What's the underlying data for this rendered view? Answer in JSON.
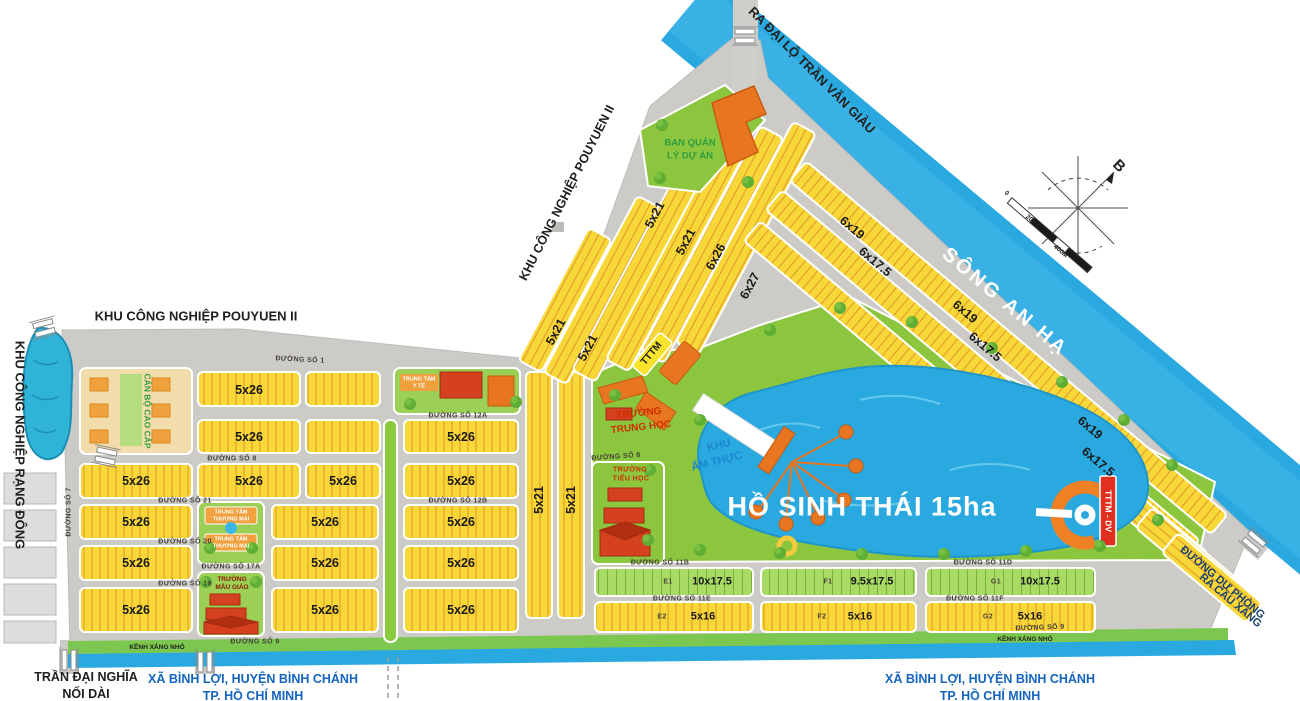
{
  "region_labels": {
    "river": "SÔNG AN HẠ",
    "lake": "HỒ SINH THÁI 15ha",
    "exit_top": "RA ĐẠI LỘ TRẦN VĂN GIÀU",
    "kcn_pouyuen": "KHU CÔNG NGHIỆP POUYUEN II",
    "kcn_rangdong": "KHU CÔNG NGHIỆP RẠNG ĐÔNG",
    "reserve_road_1": "ĐƯỜNG DỰ PHÒNG",
    "reserve_road_2": "RA CẦU XÁNG",
    "tran_dai_nghia_1": "TRẦN ĐẠI NGHĨA",
    "tran_dai_nghia_2": "NỐI DÀI",
    "commune_1": "XÃ BÌNH LỢI, HUYỆN BÌNH CHÁNH",
    "commune_2": "TP. HỒ CHÍ MINH",
    "canal": "KÊNH XÁNG NHỎ",
    "north": "B",
    "scale_0": "0",
    "scale_mid": "200M",
    "scale_end": "400M"
  },
  "facilities": {
    "mgmt_1": "BAN QUẢN",
    "mgmt_2": "LÝ DỰ ÁN",
    "tttm": "TTTM",
    "tttm_dv": "TTTM - DV",
    "food_1": "KHU",
    "food_2": "ẨM THỰC",
    "high_school_1": "TRƯỜNG",
    "high_school_2": "TRUNG HỌC",
    "primary_school_1": "TRƯỜNG",
    "primary_school_2": "TIỂU HỌC",
    "kindergarten_1": "TRƯỜNG",
    "kindergarten_2": "MẪU GIÁO",
    "medical_1": "TRUNG TÂM",
    "medical_2": "Y TẾ",
    "commercial_1": "TRUNG TÂM",
    "commercial_2": "THƯƠNG MẠI",
    "staff_housing": "CÁN BỘ CAO CẤP"
  },
  "lot_labels": {
    "t5x26": "5x26",
    "t5x21": "5x21",
    "t6x26": "6x26",
    "t6x27": "6x27",
    "t6x19": "6x19",
    "t6x17": "6x17.5",
    "t10x17": "10x17.5",
    "t9x17": "9.5x17.5",
    "t5x16": "5x16"
  },
  "zones": {
    "e1": "E1",
    "e2": "E2",
    "f1": "F1",
    "f2": "F2",
    "g1": "G1",
    "g2": "G2"
  },
  "streets": {
    "s1": "ĐƯỜNG SỐ 1",
    "s7": "ĐƯỜNG SỐ 7",
    "s8": "ĐƯỜNG SỐ 8",
    "s9": "ĐƯỜNG SỐ 9",
    "s12a": "ĐƯỜNG SỐ 12A",
    "s12b": "ĐƯỜNG SỐ 12B",
    "s17a": "ĐƯỜNG SỐ 17A",
    "s19": "ĐƯỜNG SỐ 19",
    "s20": "ĐƯỜNG SỐ 20",
    "s21": "ĐƯỜNG SỐ 21",
    "s11b": "ĐƯỜNG SỐ 11B",
    "s11d": "ĐƯỜNG SỐ 11D",
    "s11e": "ĐƯỜNG SỐ 11E",
    "s11f": "ĐƯỜNG SỐ 11F"
  },
  "colors": {
    "water": "#2aa9e0",
    "road": "#cccbc7",
    "lot_yellow": "#f8d838",
    "lot_tick": "#e2992b",
    "park_green": "#8cc63f",
    "lot_green": "#a8da64",
    "building_orange": "#e8751f",
    "building_red": "#d5401f",
    "tag_red": "#e03020"
  }
}
